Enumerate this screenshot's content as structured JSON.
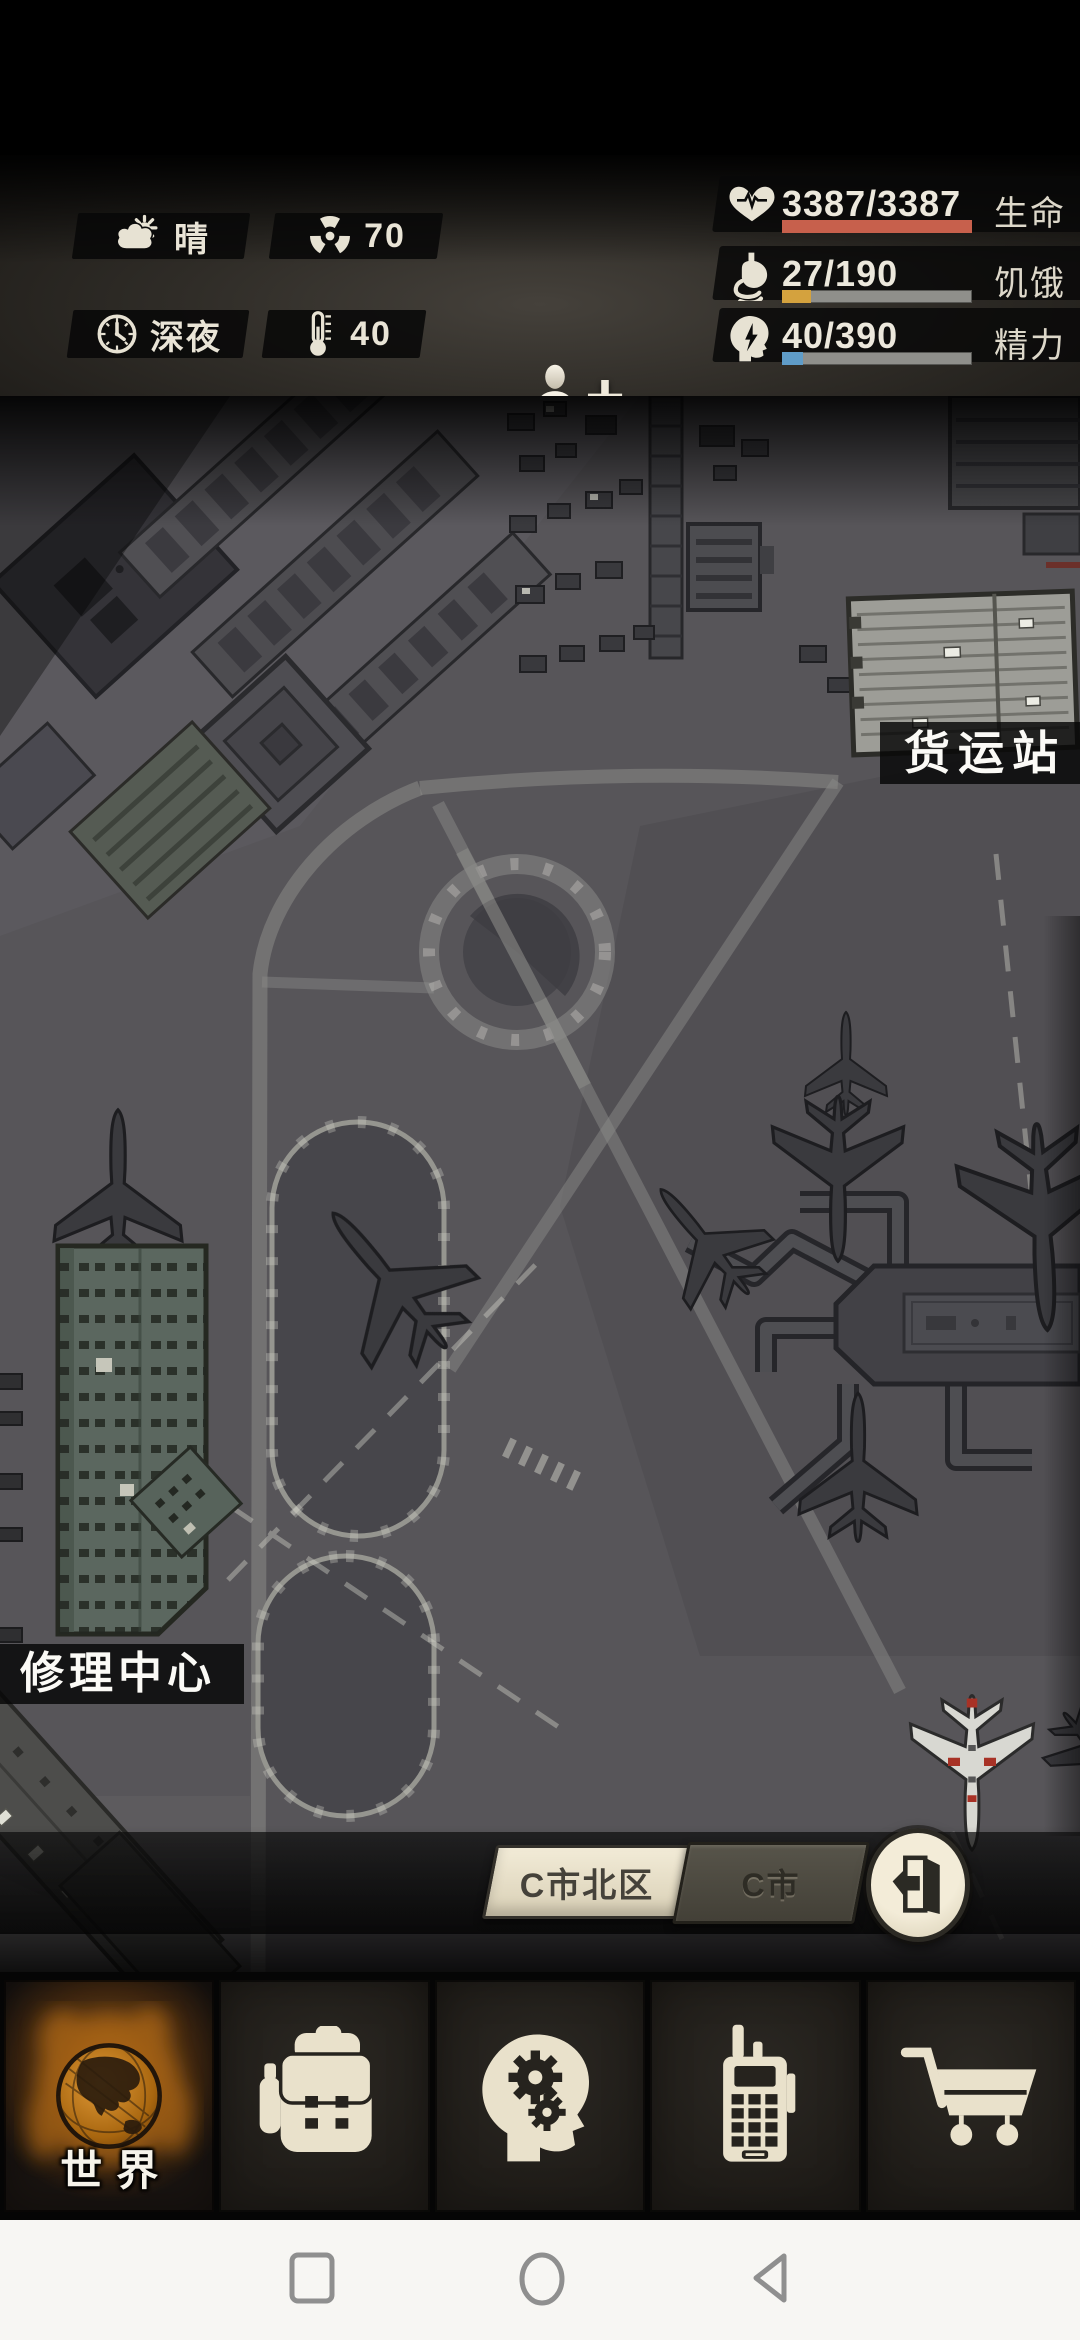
{
  "hud": {
    "weather_label": "晴",
    "radiation_value": "70",
    "time_label": "深夜",
    "temperature_value": "40",
    "zoom_in_label": "+",
    "zoom_out_label": "−",
    "stats": {
      "health": {
        "value": "3387/3387",
        "label": "生命",
        "pct": 100,
        "color": "#c7604c"
      },
      "hunger": {
        "value": "27/190",
        "label": "饥饿",
        "pct": 15,
        "color": "#d4a23e"
      },
      "energy": {
        "value": "40/390",
        "label": "精力",
        "pct": 11,
        "color": "#5f9cc8"
      }
    }
  },
  "map": {
    "poi_cargo_label": "货运站",
    "poi_repair_label": "修理中心"
  },
  "region_nav": {
    "current_label": "C市北区",
    "parent_label": "C市"
  },
  "tab_bar": {
    "world_label": "世界",
    "world_accent": "#c87a1e"
  }
}
